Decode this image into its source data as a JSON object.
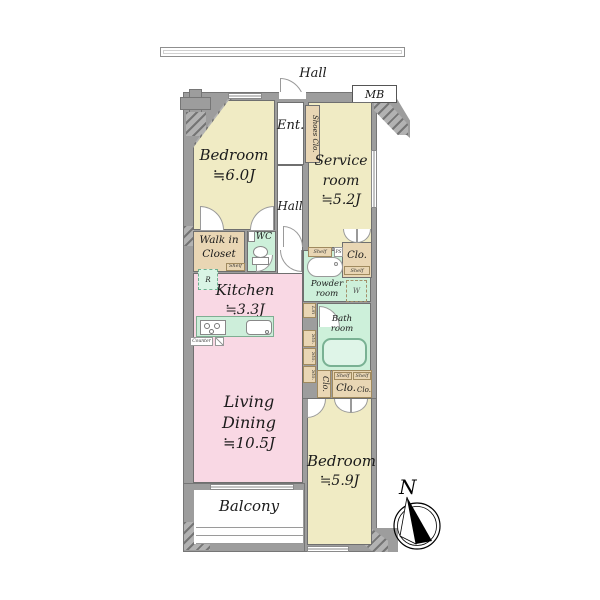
{
  "outside": {
    "hall": "Hall",
    "mb": "MB"
  },
  "rooms": {
    "bedroom1": {
      "name": "Bedroom",
      "size": "≒6.0J"
    },
    "service": {
      "line1": "Service",
      "line2": "room",
      "size": "≒5.2J"
    },
    "kitchen": {
      "name": "Kitchen",
      "size": "≒3.3J"
    },
    "living": {
      "name": "Living Dining",
      "size": "≒10.5J"
    },
    "bedroom2": {
      "name": "Bedroom",
      "size": "≒5.9J"
    },
    "balcony": {
      "name": "Balcony"
    },
    "entrance": {
      "name": "Ent."
    },
    "hall": {
      "name": "Hall"
    },
    "wic": {
      "line1": "Walk in",
      "line2": "Closet"
    },
    "wc": {
      "name": "WC"
    },
    "powder": {
      "line1": "Powder",
      "line2": "room"
    },
    "bath": {
      "line1": "Bath",
      "line2": "room"
    },
    "shoes": {
      "name": "Shoes Clo."
    }
  },
  "fixtures": {
    "shelf": "Shelf",
    "sto": "Sto.",
    "clo": "Clo.",
    "lin": "Lin",
    "washer": "W",
    "fridge": "R",
    "counter": "Counter",
    "ps": "PS"
  },
  "compass": {
    "north": "N"
  },
  "colors": {
    "room_cream": "#f0ebc4",
    "room_pink": "#f9d8e4",
    "room_green": "#cdf0da",
    "closet_tan": "#e9d6b4",
    "wall_gray": "#9d9d9d"
  }
}
